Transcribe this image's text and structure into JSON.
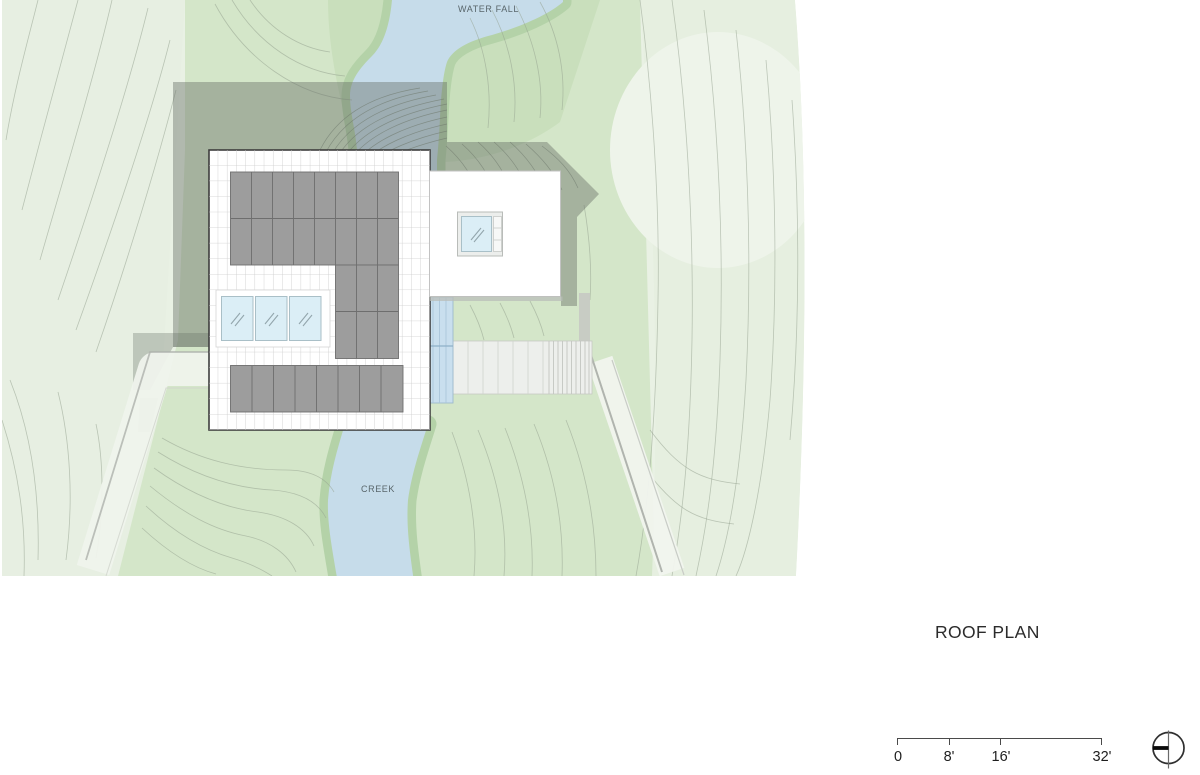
{
  "map": {
    "water_fall_label": "WATER FALL",
    "creek_label": "CREEK"
  },
  "title": "ROOF PLAN",
  "scale_bar": {
    "tick_labels": [
      "0",
      "8'",
      "16'",
      "32'"
    ]
  },
  "north_arrow": "north-arrow",
  "colors": {
    "terrain_base": "#e9f1e4",
    "terrain_light": "#e7efe2",
    "terrain_medium": "#d4e6c9",
    "terrain_dark_band": "#c9dfbc",
    "clearing": "#eef4ea",
    "water": "#c6dcea",
    "water_bank": "#b4d2a8",
    "contour_line": "#93a18e",
    "building_shadow": "rgba(99,108,99,0.42)",
    "roof_deck": "#ffffff",
    "roof_grid_line": "#cbcbcb",
    "roof_panel": "#9d9d9d",
    "roof_panel_border": "#6e6e6e",
    "skylight_glass": "#dbeef6",
    "stair_water": "#c9dfee",
    "walkway": "#edefec",
    "path_light": "#eff3ec",
    "drawing_text": "#2b2b2b"
  }
}
